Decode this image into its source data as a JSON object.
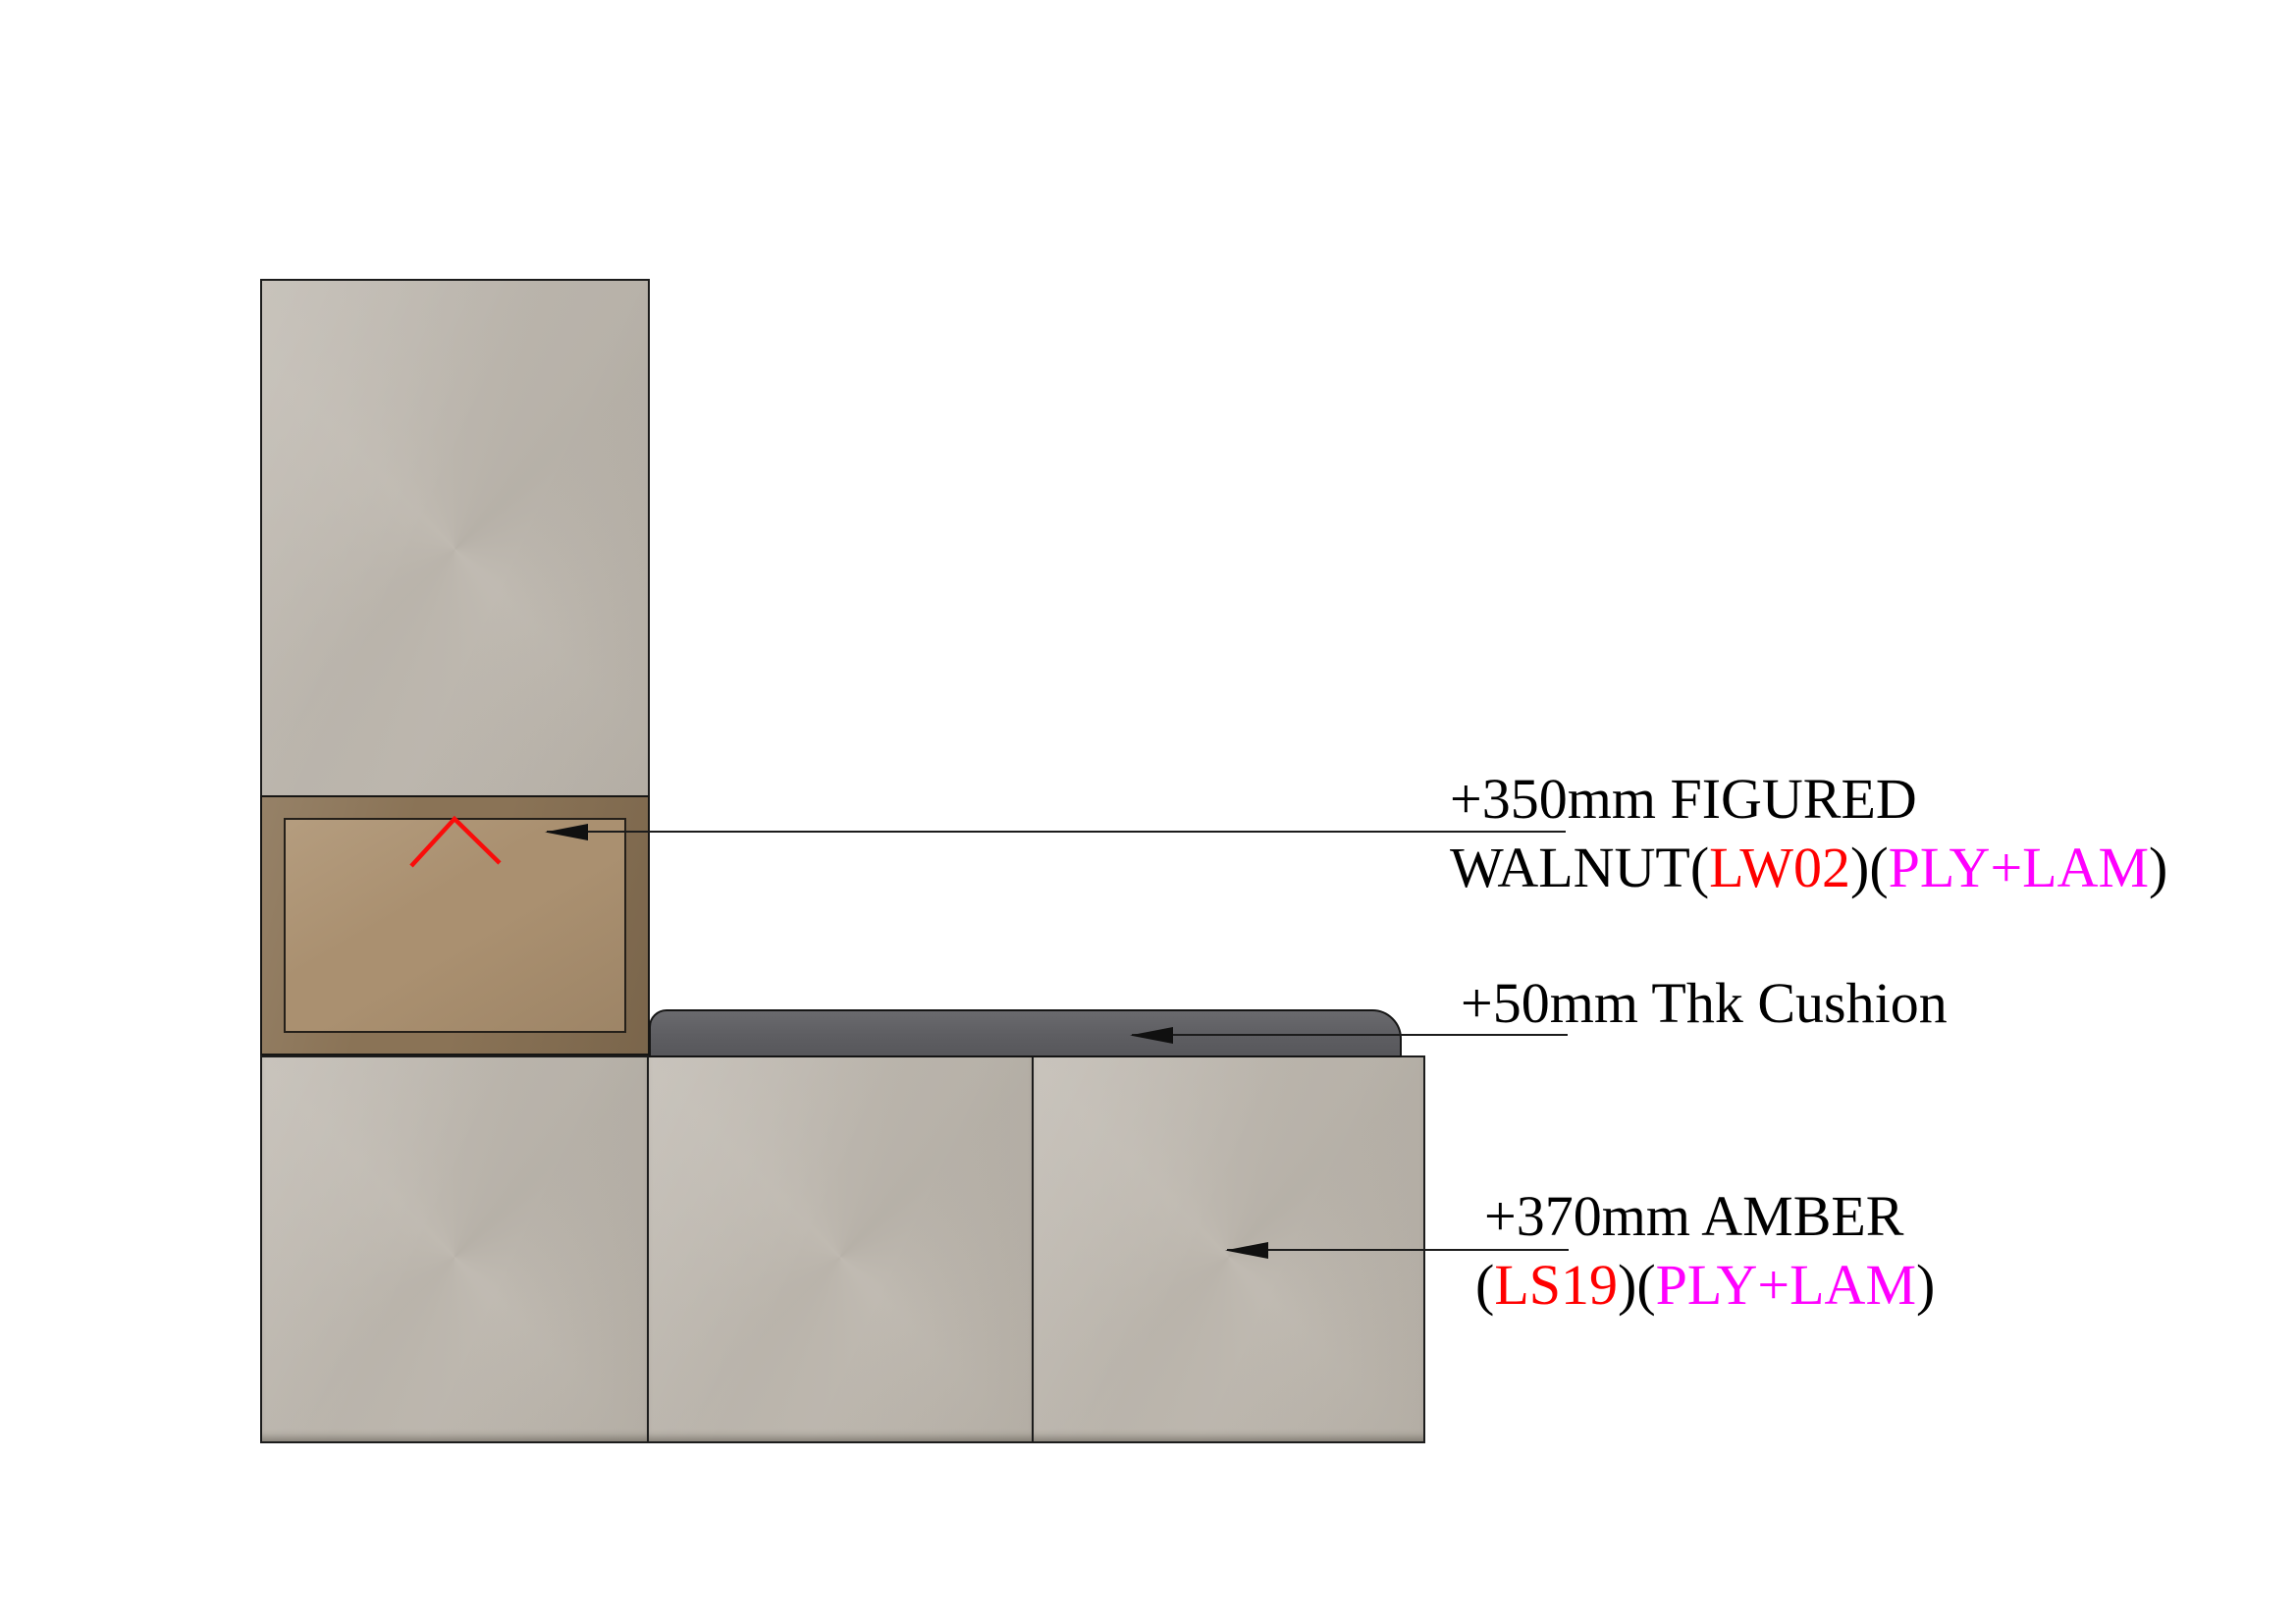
{
  "drawing": {
    "kind": "joinery-elevation-detail",
    "background": "#ffffff"
  },
  "colors": {
    "outline": "#1c1c1c",
    "panel_laminate": "#bdb7ae",
    "walnut_frame": "#8a7356",
    "walnut_panel": "#aa9070",
    "cushion": "#5f5f63",
    "annotation_black": "#000000",
    "annotation_red": "#ff0000",
    "annotation_magenta": "#ff00ff",
    "marker_red": "#f90d0b"
  },
  "annotations": [
    {
      "id": "figured-walnut",
      "line1": [
        {
          "text": "+350mm FIGURED",
          "color": "#000000"
        }
      ],
      "line2": [
        {
          "text": "WALNUT(",
          "color": "#000000"
        },
        {
          "text": "LW02",
          "color": "#ff0000"
        },
        {
          "text": ")(",
          "color": "#000000"
        },
        {
          "text": "PLY+LAM",
          "color": "#ff00ff"
        },
        {
          "text": ")",
          "color": "#000000"
        }
      ]
    },
    {
      "id": "thk-cushion",
      "line1": [
        {
          "text": "+50mm Thk Cushion",
          "color": "#000000"
        }
      ]
    },
    {
      "id": "amber-laminate",
      "line1": [
        {
          "text": "+370mm AMBER",
          "color": "#000000"
        }
      ],
      "line2": [
        {
          "text": "(",
          "color": "#000000"
        },
        {
          "text": "LS19",
          "color": "#ff0000"
        },
        {
          "text": ")(",
          "color": "#000000"
        },
        {
          "text": "PLY+LAM",
          "color": "#ff00ff"
        },
        {
          "text": ")",
          "color": "#000000"
        }
      ]
    }
  ]
}
